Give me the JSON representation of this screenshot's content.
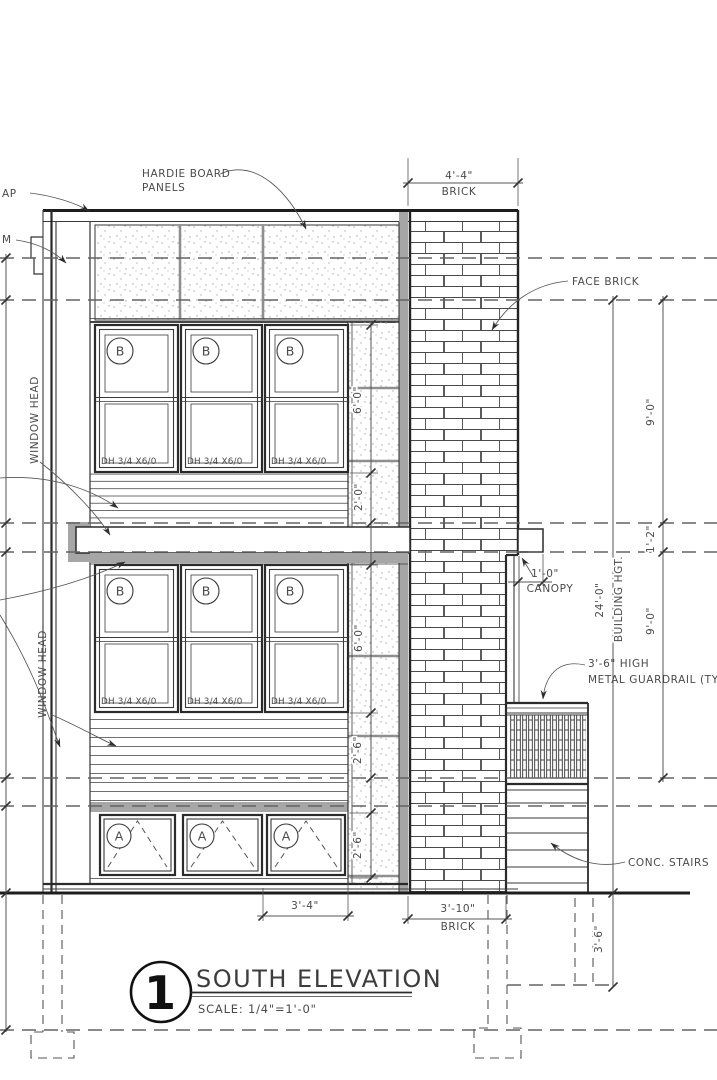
{
  "drawing": {
    "labels": {
      "cap_partial": "AP",
      "trim_partial": "M",
      "hardie_1": "HARDIE BOARD",
      "hardie_2": "PANELS",
      "face_brick": "FACE BRICK",
      "window_head_upper": "WINDOW HEAD",
      "window_head_lower": "WINDOW HEAD",
      "canopy": "CANOPY",
      "guardrail_1": "3'-6\" HIGH",
      "guardrail_2": "METAL GUARDRAIL (TYP.)",
      "conc_stairs": "CONC. STAIRS"
    },
    "dims": {
      "brick_top_value": "4'-4\"",
      "brick_top_label": "BRICK",
      "right": [
        "9'-0\"",
        "1'-2\"",
        "9'-0\""
      ],
      "building_height_value": "24'-0\"",
      "building_height_label": "BUILDING HGT.",
      "canopy_depth": "1'-0\"",
      "strip": [
        "6'-0\"",
        "2'-0\"",
        "6'-0\"",
        "2'-6\"",
        "2'-6\""
      ],
      "window_width": "3'-4\"",
      "brick_bottom_value": "3'-10\"",
      "brick_bottom_label": "BRICK",
      "foundation_depth": "3'-6\""
    },
    "windows": {
      "tag_upper": "B",
      "tag_lower": "A",
      "size_label": "DH 3/4 X6/0"
    },
    "title_block": {
      "number": "1",
      "title": "SOUTH ELEVATION",
      "scale": "SCALE: 1/4\"=1'-0\""
    },
    "colors": {
      "line": "#2e2e2e",
      "shadow": "#a6a6a6",
      "dashed_datum": "#636363"
    }
  }
}
